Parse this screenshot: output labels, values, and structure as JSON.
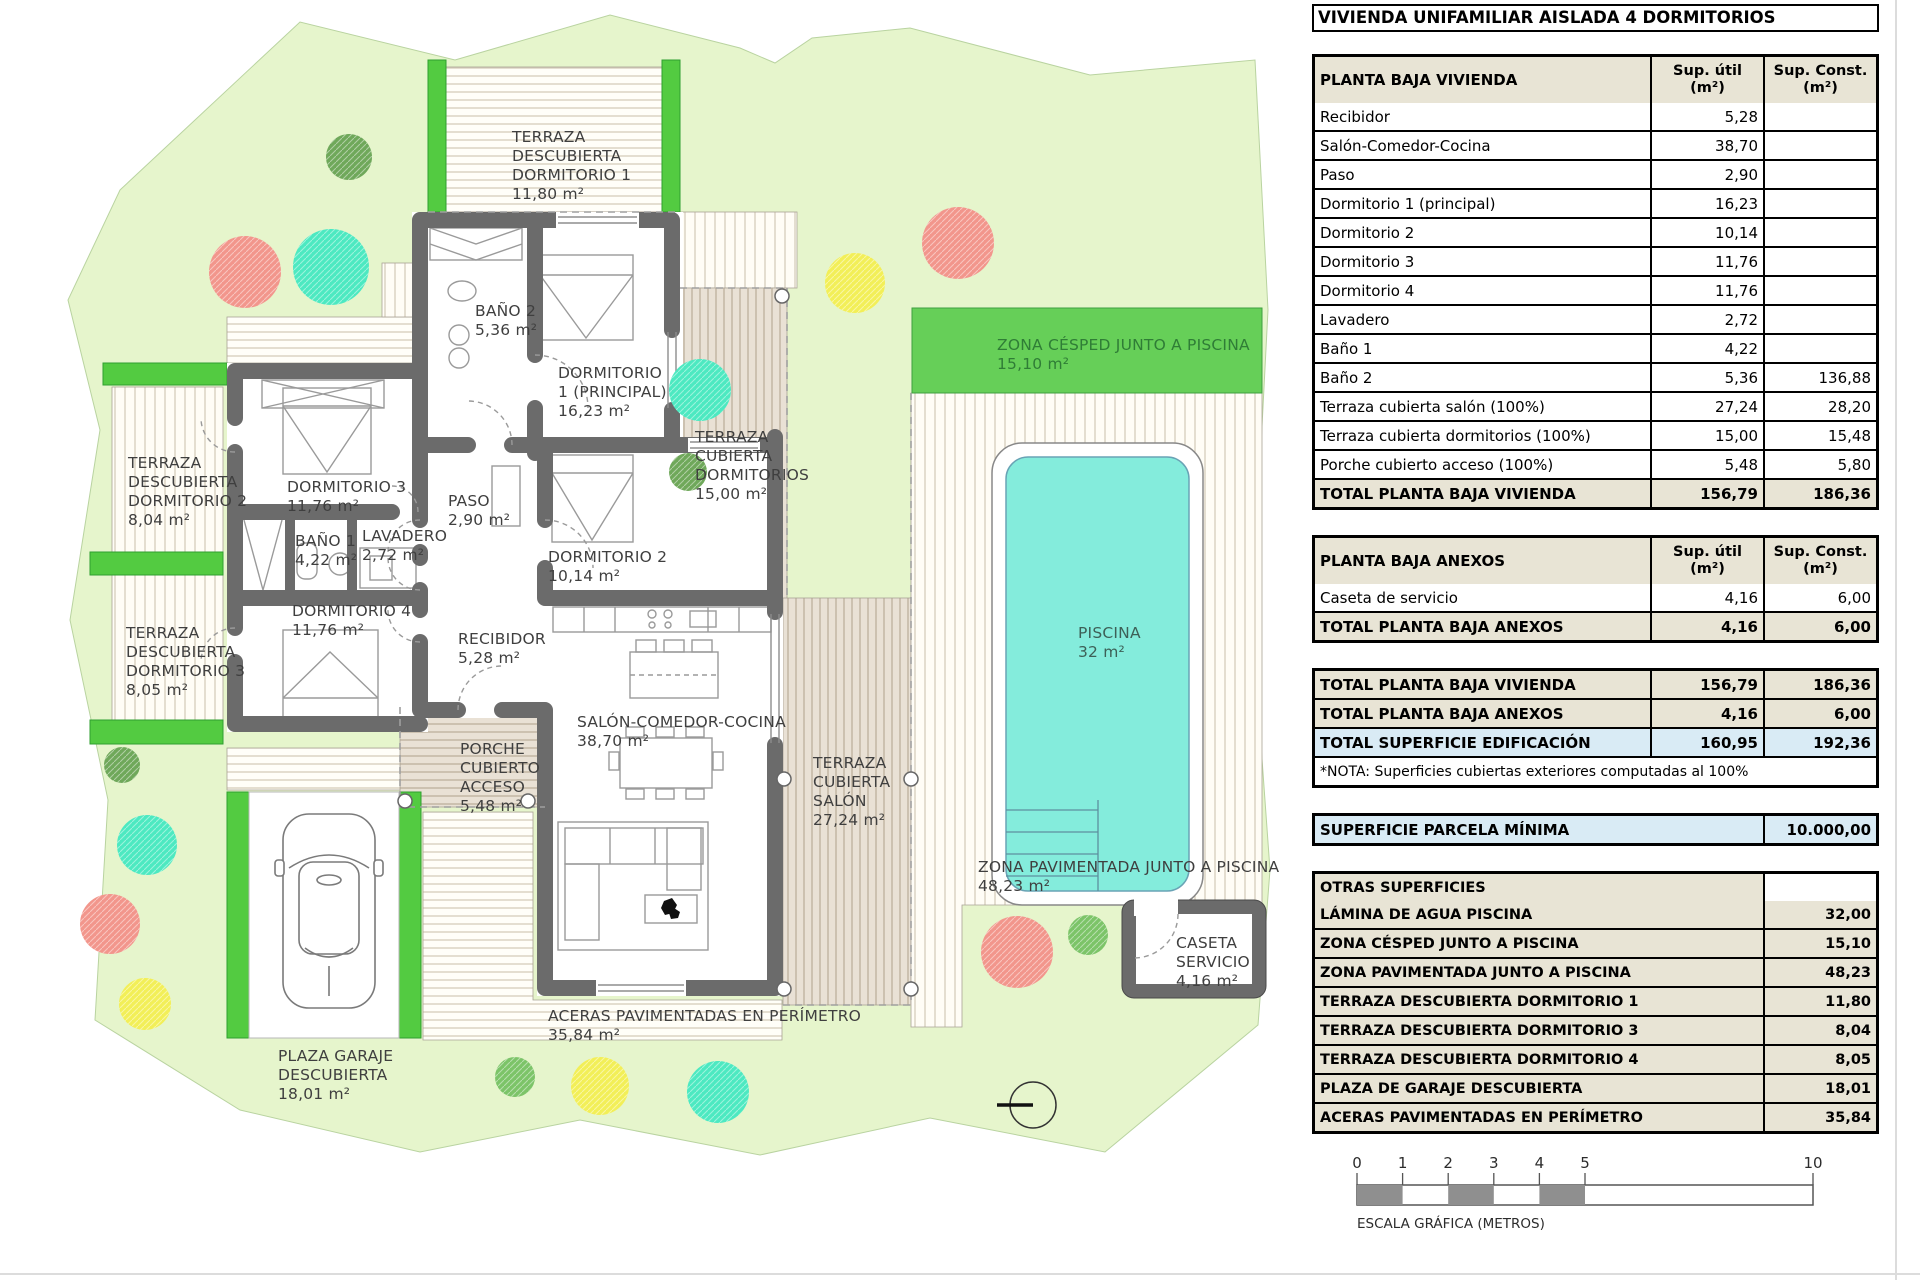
{
  "title": "VIVIENDA UNIFAMILIAR AISLADA 4 DORMITORIOS",
  "colors": {
    "parcel": "#e6f5cc",
    "accent_green": "#53cb41",
    "cesped": "#66cf58",
    "pool_water": "#84ecdc",
    "wall": "#6b6b6b",
    "table_beige": "#e8e4d5",
    "table_blue": "#d9ebf5",
    "tan_terrace": "#e9e1d5",
    "trees": {
      "salmon": "#f2968c",
      "teal": "#4de9c1",
      "yellow": "#f2ef58",
      "green": "#6fa85a",
      "green2": "#7cc468"
    }
  },
  "tables": {
    "col_util": "Sup. útil",
    "col_const": "Sup. Const.",
    "unit": "(m²)",
    "vivienda": {
      "header": "PLANTA BAJA VIVIENDA",
      "rows": [
        {
          "l": "Recibidor",
          "u": "5,28",
          "c": ""
        },
        {
          "l": "Salón-Comedor-Cocina",
          "u": "38,70",
          "c": ""
        },
        {
          "l": "Paso",
          "u": "2,90",
          "c": ""
        },
        {
          "l": "Dormitorio 1 (principal)",
          "u": "16,23",
          "c": ""
        },
        {
          "l": "Dormitorio 2",
          "u": "10,14",
          "c": ""
        },
        {
          "l": "Dormitorio 3",
          "u": "11,76",
          "c": ""
        },
        {
          "l": "Dormitorio 4",
          "u": "11,76",
          "c": ""
        },
        {
          "l": "Lavadero",
          "u": "2,72",
          "c": ""
        },
        {
          "l": "Baño 1",
          "u": "4,22",
          "c": ""
        },
        {
          "l": "Baño 2",
          "u": "5,36",
          "c": "136,88"
        },
        {
          "l": "Terraza cubierta salón (100%)",
          "u": "27,24",
          "c": "28,20"
        },
        {
          "l": "Terraza cubierta dormitorios (100%)",
          "u": "15,00",
          "c": "15,48"
        },
        {
          "l": "Porche cubierto acceso (100%)",
          "u": "5,48",
          "c": "5,80"
        }
      ],
      "total": {
        "l": "TOTAL PLANTA BAJA VIVIENDA",
        "u": "156,79",
        "c": "186,36"
      }
    },
    "anexos": {
      "header": "PLANTA BAJA ANEXOS",
      "rows": [
        {
          "l": "Caseta de servicio",
          "u": "4,16",
          "c": "6,00"
        }
      ],
      "total": {
        "l": "TOTAL PLANTA BAJA ANEXOS",
        "u": "4,16",
        "c": "6,00"
      }
    },
    "totales": [
      {
        "l": "TOTAL PLANTA BAJA VIVIENDA",
        "u": "156,79",
        "c": "186,36",
        "cls": "b"
      },
      {
        "l": "TOTAL PLANTA BAJA ANEXOS",
        "u": "4,16",
        "c": "6,00",
        "cls": "b"
      },
      {
        "l": "TOTAL SUPERFICIE EDIFICACIÓN",
        "u": "160,95",
        "c": "192,36",
        "cls": "hl"
      }
    ],
    "nota": "*NOTA: Superficies cubiertas exteriores computadas al 100%",
    "parcela": {
      "label": "SUPERFICIE PARCELA MÍNIMA",
      "value": "10.000,00"
    },
    "otras": {
      "header": "OTRAS SUPERFICIES",
      "rows": [
        {
          "l": "LÁMINA DE AGUA PISCINA",
          "v": "32,00"
        },
        {
          "l": "ZONA CÉSPED JUNTO A PISCINA",
          "v": "15,10"
        },
        {
          "l": "ZONA PAVIMENTADA JUNTO A PISCINA",
          "v": "48,23"
        },
        {
          "l": "TERRAZA DESCUBIERTA DORMITORIO 1",
          "v": "11,80"
        },
        {
          "l": "TERRAZA DESCUBIERTA DORMITORIO 3",
          "v": "8,04"
        },
        {
          "l": "TERRAZA DESCUBIERTA DORMITORIO 4",
          "v": "8,05"
        },
        {
          "l": "PLAZA DE GARAJE DESCUBIERTA",
          "v": "18,01"
        },
        {
          "l": "ACERAS PAVIMENTADAS EN PERÍMETRO",
          "v": "35,84"
        }
      ]
    }
  },
  "scalebar": {
    "ticks": [
      0,
      1,
      2,
      3,
      4,
      5,
      10
    ],
    "label": "ESCALA GRÁFICA (METROS)"
  },
  "plan": {
    "labels": [
      {
        "n": "terraza-descubierta-dorm1",
        "x": 512,
        "y": 142,
        "lines": [
          "TERRAZA",
          "DESCUBIERTA",
          "DORMITORIO 1",
          "11,80 m²"
        ]
      },
      {
        "n": "bano-2",
        "x": 475,
        "y": 316,
        "lines": [
          "BAÑO 2",
          "5,36 m²"
        ]
      },
      {
        "n": "dormitorio-1",
        "x": 558,
        "y": 378,
        "lines": [
          "DORMITORIO",
          "1 (PRINCIPAL)",
          "16,23 m²"
        ]
      },
      {
        "n": "terraza-cubierta-dormitorios",
        "x": 695,
        "y": 442,
        "lines": [
          "TERRAZA",
          "CUBIERTA",
          "DORMITORIOS",
          "15,00 m²"
        ]
      },
      {
        "n": "zona-cesped",
        "x": 997,
        "y": 350,
        "lines": [
          "ZONA CÉSPED JUNTO A PISCINA",
          "15,10 m²"
        ],
        "color": "#2f7d36"
      },
      {
        "n": "terraza-descubierta-dorm2",
        "x": 128,
        "y": 468,
        "lines": [
          "TERRAZA",
          "DESCUBIERTA",
          "DORMITORIO 2",
          "8,04 m²"
        ]
      },
      {
        "n": "dormitorio-3",
        "x": 287,
        "y": 492,
        "lines": [
          "DORMITORIO 3",
          "11,76 m²"
        ]
      },
      {
        "n": "paso",
        "x": 448,
        "y": 506,
        "lines": [
          "PASO",
          "2,90 m²"
        ]
      },
      {
        "n": "bano-1",
        "x": 295,
        "y": 546,
        "lines": [
          "BAÑO 1",
          "4,22 m²"
        ]
      },
      {
        "n": "lavadero",
        "x": 362,
        "y": 541,
        "lines": [
          "LAVADERO",
          "2,72 m²"
        ]
      },
      {
        "n": "dormitorio-2",
        "x": 548,
        "y": 562,
        "lines": [
          "DORMITORIO 2",
          "10,14 m²"
        ]
      },
      {
        "n": "dormitorio-4",
        "x": 292,
        "y": 616,
        "lines": [
          "DORMITORIO 4",
          "11,76 m²"
        ]
      },
      {
        "n": "terraza-descubierta-dorm3",
        "x": 126,
        "y": 638,
        "lines": [
          "TERRAZA",
          "DESCUBIERTA",
          "DORMITORIO 3",
          "8,05 m²"
        ]
      },
      {
        "n": "recibidor",
        "x": 458,
        "y": 644,
        "lines": [
          "RECIBIDOR",
          "5,28 m²"
        ]
      },
      {
        "n": "salon-comedor-cocina",
        "x": 577,
        "y": 727,
        "lines": [
          "SALÓN-COMEDOR-COCINA",
          "38,70 m²"
        ]
      },
      {
        "n": "porche-cubierto",
        "x": 460,
        "y": 754,
        "lines": [
          "PORCHE",
          "CUBIERTO",
          "ACCESO",
          "5,48 m²"
        ]
      },
      {
        "n": "terraza-cubierta-salon",
        "x": 813,
        "y": 768,
        "lines": [
          "TERRAZA",
          "CUBIERTA",
          "SALÓN",
          "27,24 m²"
        ]
      },
      {
        "n": "piscina",
        "x": 1078,
        "y": 638,
        "lines": [
          "PISCINA",
          "32 m²"
        ],
        "color": "#3d6057"
      },
      {
        "n": "zona-pavimentada",
        "x": 978,
        "y": 872,
        "lines": [
          "ZONA PAVIMENTADA JUNTO A PISCINA",
          "48,23 m²"
        ]
      },
      {
        "n": "caseta-servicio",
        "x": 1176,
        "y": 948,
        "lines": [
          "CASETA",
          "SERVICIO",
          "4,16 m²"
        ]
      },
      {
        "n": "aceras",
        "x": 548,
        "y": 1021,
        "lines": [
          "ACERAS PAVIMENTADAS EN PERÍMETRO",
          "35,84 m²"
        ]
      },
      {
        "n": "plaza-garaje",
        "x": 278,
        "y": 1061,
        "lines": [
          "PLAZA GARAJE",
          "DESCUBIERTA",
          "18,01 m²"
        ]
      }
    ],
    "trees": [
      {
        "x": 349,
        "y": 157,
        "r": 23,
        "c": "green"
      },
      {
        "x": 245,
        "y": 272,
        "r": 36,
        "c": "salmon"
      },
      {
        "x": 331,
        "y": 267,
        "r": 38,
        "c": "teal"
      },
      {
        "x": 855,
        "y": 283,
        "r": 30,
        "c": "yellow"
      },
      {
        "x": 958,
        "y": 243,
        "r": 36,
        "c": "salmon"
      },
      {
        "x": 700,
        "y": 390,
        "r": 31,
        "c": "teal"
      },
      {
        "x": 688,
        "y": 472,
        "r": 19,
        "c": "green"
      },
      {
        "x": 122,
        "y": 765,
        "r": 18,
        "c": "green"
      },
      {
        "x": 147,
        "y": 845,
        "r": 30,
        "c": "teal"
      },
      {
        "x": 110,
        "y": 924,
        "r": 30,
        "c": "salmon"
      },
      {
        "x": 145,
        "y": 1004,
        "r": 26,
        "c": "yellow"
      },
      {
        "x": 515,
        "y": 1077,
        "r": 20,
        "c": "green2"
      },
      {
        "x": 600,
        "y": 1086,
        "r": 29,
        "c": "yellow"
      },
      {
        "x": 718,
        "y": 1092,
        "r": 31,
        "c": "teal"
      },
      {
        "x": 1017,
        "y": 952,
        "r": 36,
        "c": "salmon"
      },
      {
        "x": 1088,
        "y": 935,
        "r": 20,
        "c": "green2"
      }
    ]
  }
}
